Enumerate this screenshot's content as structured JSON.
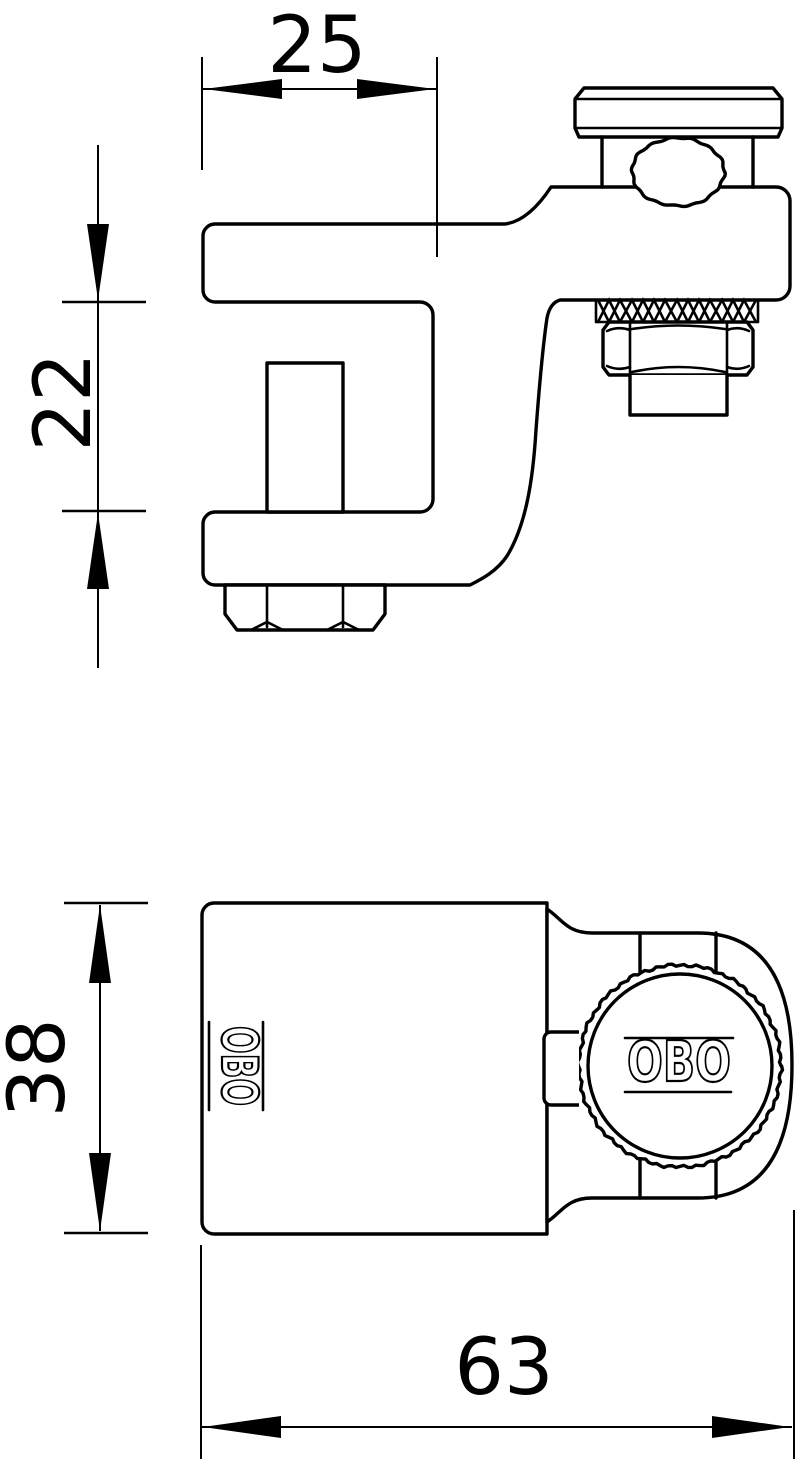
{
  "colors": {
    "background": "#ffffff",
    "line": "#000000"
  },
  "side_view": {
    "dim_jaw_depth": {
      "label": "25"
    },
    "dim_jaw_opening": {
      "label": "22"
    }
  },
  "front_view": {
    "dim_body_height": {
      "label": "38"
    },
    "dim_total_width": {
      "label": "63"
    },
    "logo_body": {
      "text": "OBO"
    },
    "logo_knob": {
      "text": "OBO"
    }
  }
}
